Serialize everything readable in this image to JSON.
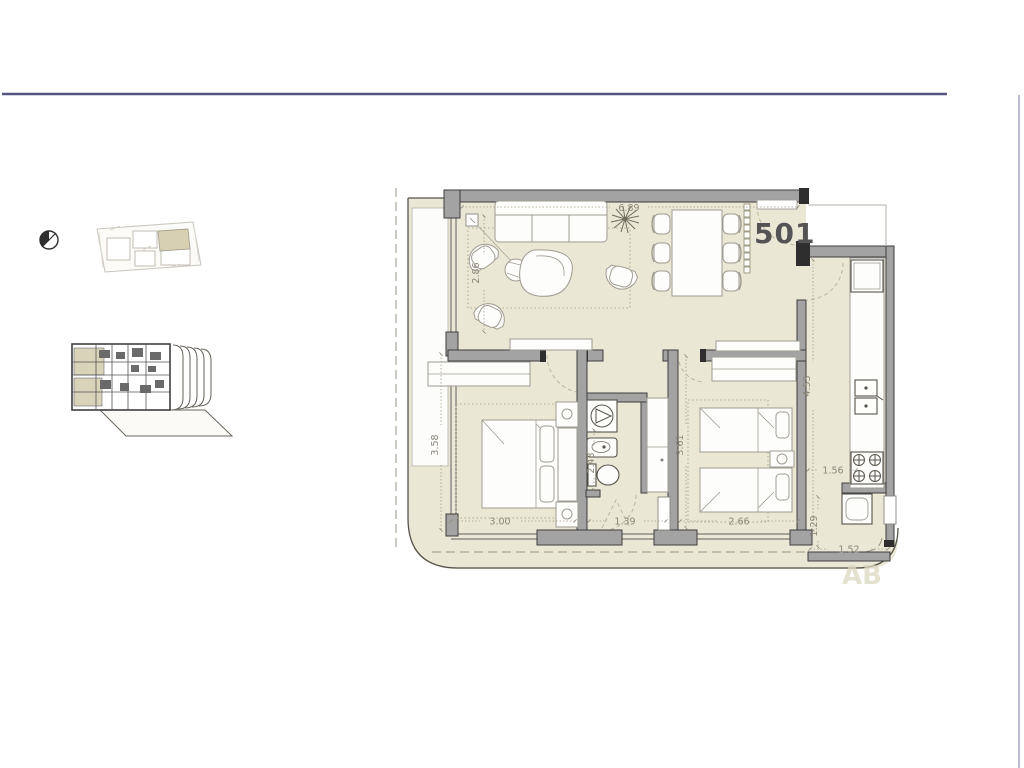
{
  "page": {
    "background": "#ffffff",
    "top_rule_color": "#54547e",
    "right_rule_color": "#a0a0bc"
  },
  "floor_plan": {
    "unit_label": "501",
    "unit_label_color": "#545456",
    "floor_color": "#eae7d5",
    "wall_color": "#a3a3a3",
    "watermark": "AB",
    "dimensions": {
      "living_width": "6.89",
      "living_depth": "2.86",
      "master_depth": "3.58",
      "master_width": "3.00",
      "hall_width": "1.39",
      "bath_depth": "2.43",
      "bedroom2_depth": "3.61",
      "bedroom2_width": "2.66",
      "kitchen_depth": "4.53",
      "kitchen_width": "1.56",
      "laundry_depth": "1.29",
      "laundry_width": "1.52"
    }
  },
  "thumbnails": {
    "north_arrow_icon": "north-arrow-icon",
    "site_plan": "site-plan-thumbnail",
    "stacked_plans": "stacked-floor-plans-thumbnail"
  }
}
